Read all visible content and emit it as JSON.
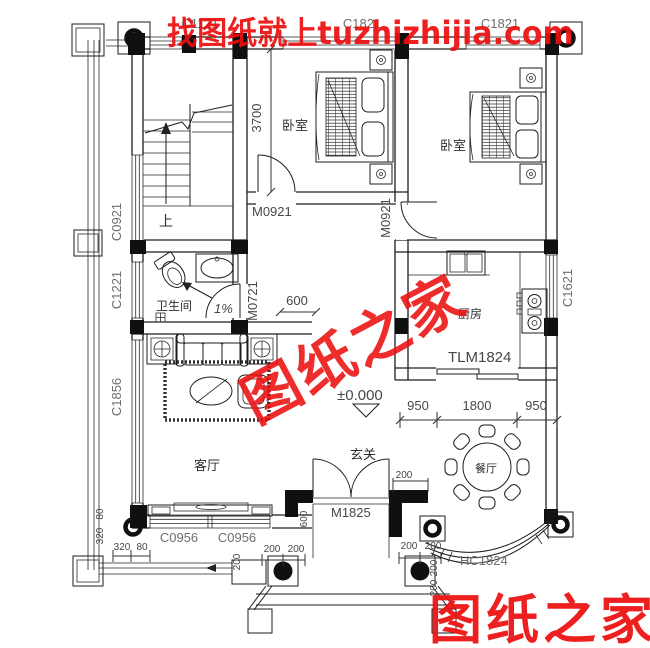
{
  "watermarks": {
    "top": "找图纸就上tuzhizhijia.com",
    "center": "图纸之家",
    "bottom_right": "图纸之家",
    "color": "#ec0f0f"
  },
  "rooms": {
    "bedroom_left": "卧室",
    "bedroom_right": "卧室",
    "bathroom": "卫生间",
    "kitchen": "厨房",
    "living_room": "客厅",
    "foyer": "玄关",
    "dining_room": "餐厅"
  },
  "stairs": {
    "up": "上"
  },
  "openings": {
    "window_top_left": "C1121",
    "window_top_middle": "C1821",
    "window_top_right": "C1821",
    "window_left_stairs": "C0921",
    "window_left_bathroom": "C1221",
    "window_left_living": "C1856",
    "window_right_kitchen": "C1621",
    "window_living_south_1": "C0956",
    "window_living_south_2": "C0956",
    "door_bedroom_left": "M0921",
    "door_bedroom_right": "M0921",
    "door_bathroom": "M0721",
    "door_kitchen_sliding": "TLM1824",
    "door_entry": "M1825",
    "bay_window": "HC1824"
  },
  "dimensions": {
    "bedroom_depth": "3700",
    "corridor_width": "600",
    "kitchen_left": "950",
    "kitchen_middle": "1800",
    "kitchen_right": "950",
    "floor_level": "±0.000",
    "slope": "1%",
    "porch_depth": "600",
    "d200": "200",
    "d320": "320",
    "d80": "80"
  }
}
